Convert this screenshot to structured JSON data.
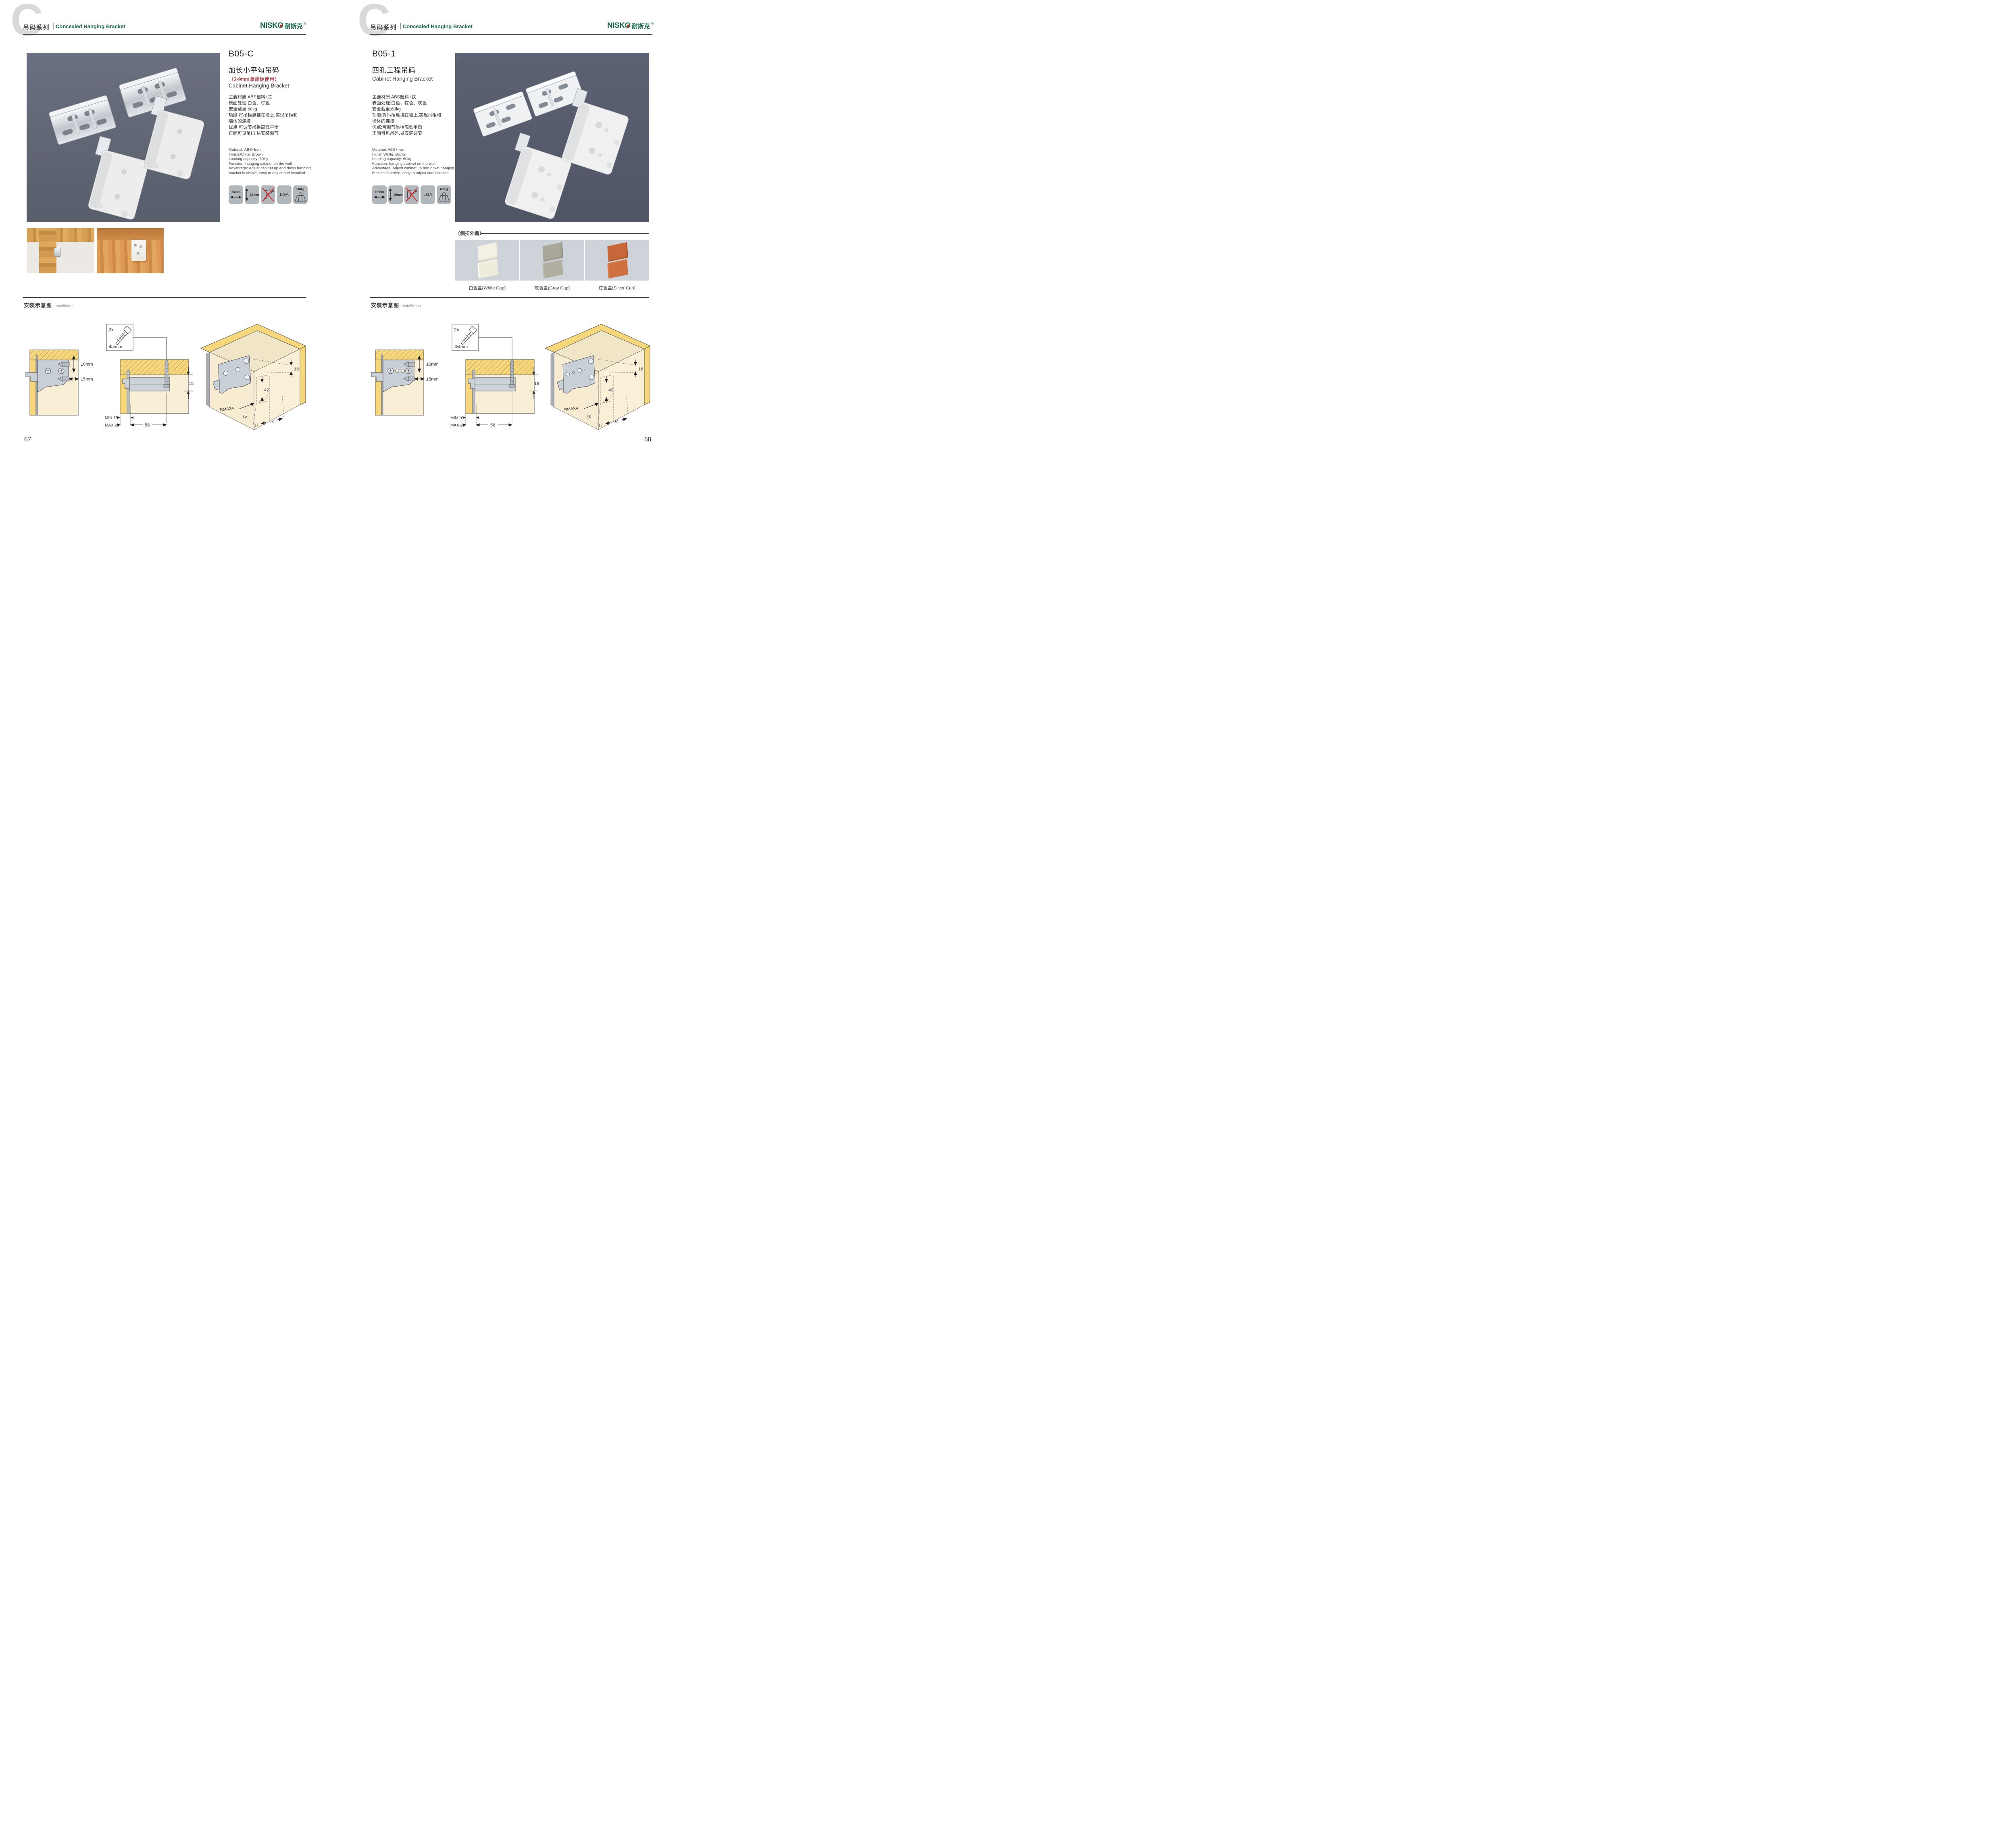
{
  "header": {
    "watermark_letter": "C",
    "series_cn": "吊码系列",
    "series_en": "Concealed Hanging Bracket",
    "brand_en": "NISKO",
    "brand_cn": "耐斯克",
    "brand_reg": "®"
  },
  "colors": {
    "brand_green": "#176a4a",
    "accent_red": "#c0181f",
    "photo_bg_left": "#656a78",
    "photo_bg_right": "#575d6e",
    "icon_tile_bg": "#b2b7bb",
    "cap_photo_bg": "#cdd3d9",
    "diagram_wood": "#f6d77b",
    "diagram_panel": "#f9efd6"
  },
  "icons": {
    "width_adjust": "15mm",
    "height_adjust": "10mm",
    "lga": "LGA",
    "load": "60Kg"
  },
  "left_page": {
    "code": "B05-C",
    "name_cn": "加长小平勾吊码",
    "red_note": "（3-9mm厚背板使用）",
    "name_en": "Cabinet Hanging Bracket",
    "specs_cn": [
      "主要材质:ABS塑料+铁",
      "表面处理:白色、棕色",
      "安全载重:60kg",
      "功能:将吊柜悬挂在墙上,实现吊柜和",
      "墙体的连接",
      "优点:可调节吊柜高低平衡",
      "正面可见吊码,易安装调节"
    ],
    "specs_en": [
      "Material: ABS+Iron",
      "Finish:White, Brown",
      "Loading capacity: 60kg",
      "Function: hanging cabinet on the wall",
      "Advantage: Adjust cabinet up and down hanging",
      "bracket is visible, easy to adjust and installed"
    ],
    "install_cn": "安装示意图",
    "install_en": "Installation",
    "page_no": "67",
    "d1_vertical": "10mm",
    "d1_horizontal": "15mm",
    "d2_count": "2x",
    "d2_dia": "Φ4mm",
    "d2_min": "MIN.15",
    "d2_max": "MAX.28",
    "d2_width": "58",
    "d2_height": "18",
    "d3_top": "16",
    "d3_mid": "42",
    "d3_radius": "RMAX4",
    "d3_b1": "16",
    "d3_b2": "17",
    "d3_b3": "32"
  },
  "right_page": {
    "code": "B05-1",
    "name_cn": "四孔工程吊码",
    "name_en": "Cabinet Hanging Bracket",
    "specs_cn": [
      "主要材质:ABS塑料+铁",
      "表面处理:白色、棕色、灰色",
      "安全载重:60kg",
      "功能:将吊柜悬挂在墙上,实现吊柜和",
      "墙体的连接",
      "优点:可调节吊柜高低平衡",
      "正面可见吊码,易安装调节"
    ],
    "specs_en": [
      "Material: ABS+Iron",
      "Finish:White, Brown",
      "Loading capacity: 60kg",
      "Function: hanging cabinet on the wall",
      "Advantage: Adjust cabinet up and down hanging",
      "bracket is visible, easy to adjust and installed"
    ],
    "caps_title": "（侧扣外盖）",
    "caps": [
      {
        "label": "白色盖(White Cap)",
        "color": "#f4f1e4"
      },
      {
        "label": "灰色盖(Gray Cap)",
        "color": "#a9a79a"
      },
      {
        "label": "棕色盖(Silver Cap)",
        "color": "#c8673a"
      }
    ],
    "install_cn": "安装示意图",
    "install_en": "Installation",
    "page_no": "68",
    "d1_vertical": "10mm",
    "d1_horizontal": "15mm",
    "d2_count": "2x",
    "d2_dia": "Φ4mm",
    "d2_min": "MIN.10",
    "d2_max": "MAX.23",
    "d2_width": "58",
    "d2_height": "18",
    "d3_top": "16",
    "d3_mid": "42",
    "d3_radius": "RMAX4",
    "d3_b1": "16",
    "d3_b2": "17",
    "d3_b3": "32"
  }
}
